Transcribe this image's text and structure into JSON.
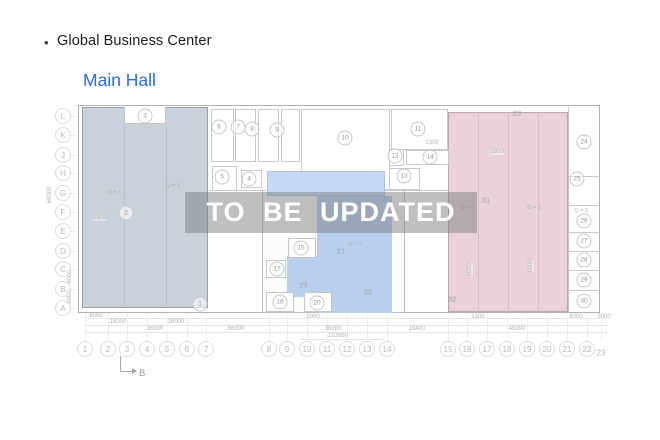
{
  "header": {
    "bullet": "•",
    "title": "Global Business Center",
    "link": "Main Hall"
  },
  "watermark": {
    "text": "TO BE UPDATED"
  },
  "section_marker": {
    "label": "B"
  },
  "colors": {
    "link_blue": "#2a6bdb",
    "zone_left": "#c9d2db",
    "zone_middle": "#b9cfee",
    "zone_middle_light": "#c6d7f3",
    "zone_right_pink": "#ead2da",
    "watermark_band": "rgba(124,127,130,0.5)",
    "watermark_text": "#ffffff",
    "drawing_line": "#c9c9c9"
  },
  "plan": {
    "row_labels": [
      {
        "t": "L",
        "x": 63,
        "y": 116
      },
      {
        "t": "K",
        "x": 63,
        "y": 135
      },
      {
        "t": "J",
        "x": 63,
        "y": 155
      },
      {
        "t": "H",
        "x": 63,
        "y": 173
      },
      {
        "t": "G",
        "x": 63,
        "y": 193
      },
      {
        "t": "F",
        "x": 63,
        "y": 212
      },
      {
        "t": "E",
        "x": 63,
        "y": 231
      },
      {
        "t": "D",
        "x": 63,
        "y": 251
      },
      {
        "t": "C",
        "x": 63,
        "y": 269
      },
      {
        "t": "B",
        "x": 63,
        "y": 289
      },
      {
        "t": "A",
        "x": 63,
        "y": 308
      }
    ],
    "col_labels": [
      {
        "t": "1",
        "x": 85,
        "y": 349
      },
      {
        "t": "2",
        "x": 108,
        "y": 349
      },
      {
        "t": "3",
        "x": 127,
        "y": 349
      },
      {
        "t": "4",
        "x": 147,
        "y": 349
      },
      {
        "t": "5",
        "x": 167,
        "y": 349
      },
      {
        "t": "6",
        "x": 187,
        "y": 349
      },
      {
        "t": "7",
        "x": 206,
        "y": 349
      },
      {
        "t": "8",
        "x": 269,
        "y": 349
      },
      {
        "t": "9",
        "x": 287,
        "y": 349
      },
      {
        "t": "10",
        "x": 307,
        "y": 349
      },
      {
        "t": "11",
        "x": 327,
        "y": 349
      },
      {
        "t": "12",
        "x": 347,
        "y": 349
      },
      {
        "t": "13",
        "x": 367,
        "y": 349
      },
      {
        "t": "14",
        "x": 387,
        "y": 349
      },
      {
        "t": "15",
        "x": 448,
        "y": 349
      },
      {
        "t": "16",
        "x": 467,
        "y": 349
      },
      {
        "t": "17",
        "x": 487,
        "y": 349
      },
      {
        "t": "18",
        "x": 507,
        "y": 349
      },
      {
        "t": "19",
        "x": 527,
        "y": 349
      },
      {
        "t": "20",
        "x": 547,
        "y": 349
      },
      {
        "t": "21",
        "x": 567,
        "y": 349
      },
      {
        "t": "22",
        "x": 587,
        "y": 349
      },
      {
        "t": "23",
        "x": 601,
        "y": 353,
        "circle": false
      }
    ],
    "room_labels": [
      {
        "t": "3",
        "x": 145,
        "y": 116
      },
      {
        "t": "2",
        "x": 126,
        "y": 213
      },
      {
        "t": "1",
        "x": 200,
        "y": 304
      },
      {
        "t": "6",
        "x": 219,
        "y": 127
      },
      {
        "t": "7",
        "x": 238,
        "y": 127
      },
      {
        "t": "8",
        "x": 252,
        "y": 129
      },
      {
        "t": "9",
        "x": 277,
        "y": 130
      },
      {
        "t": "5",
        "x": 222,
        "y": 177
      },
      {
        "t": "4",
        "x": 249,
        "y": 179
      },
      {
        "t": "10",
        "x": 345,
        "y": 138
      },
      {
        "t": "11",
        "x": 418,
        "y": 129
      },
      {
        "t": "12",
        "x": 395,
        "y": 156
      },
      {
        "t": "13",
        "x": 404,
        "y": 176
      },
      {
        "t": "14",
        "x": 430,
        "y": 157
      },
      {
        "t": "15",
        "x": 301,
        "y": 248
      },
      {
        "t": "17",
        "x": 277,
        "y": 269
      },
      {
        "t": "18",
        "x": 280,
        "y": 302
      },
      {
        "t": "20",
        "x": 317,
        "y": 303
      },
      {
        "t": "19",
        "x": 303,
        "y": 285,
        "circle": false
      },
      {
        "t": "21",
        "x": 341,
        "y": 251,
        "circle": false
      },
      {
        "t": "22",
        "x": 368,
        "y": 292,
        "circle": false
      },
      {
        "t": "23",
        "x": 517,
        "y": 113,
        "circle": false
      },
      {
        "t": "24",
        "x": 584,
        "y": 142
      },
      {
        "t": "25",
        "x": 577,
        "y": 179
      },
      {
        "t": "26",
        "x": 584,
        "y": 221
      },
      {
        "t": "27",
        "x": 584,
        "y": 241
      },
      {
        "t": "28",
        "x": 584,
        "y": 260
      },
      {
        "t": "29",
        "x": 584,
        "y": 280
      },
      {
        "t": "30",
        "x": 584,
        "y": 301
      },
      {
        "t": "31",
        "x": 486,
        "y": 200,
        "circle": false
      },
      {
        "t": "32",
        "x": 452,
        "y": 299,
        "circle": false
      }
    ],
    "dim_labels": [
      {
        "t": "6000",
        "x": 96,
        "y": 316
      },
      {
        "t": "18000",
        "x": 118,
        "y": 322
      },
      {
        "t": "18000",
        "x": 176,
        "y": 322
      },
      {
        "t": "36000",
        "x": 155,
        "y": 329
      },
      {
        "t": "56000",
        "x": 236,
        "y": 329
      },
      {
        "t": "2000",
        "x": 313,
        "y": 317
      },
      {
        "t": "36000",
        "x": 333,
        "y": 329
      },
      {
        "t": "153860",
        "x": 338,
        "y": 336
      },
      {
        "t": "18400",
        "x": 417,
        "y": 329
      },
      {
        "t": "1300",
        "x": 478,
        "y": 317
      },
      {
        "t": "45000",
        "x": 517,
        "y": 329
      },
      {
        "t": "6000",
        "x": 576,
        "y": 317
      },
      {
        "t": "3000",
        "x": 604,
        "y": 317
      },
      {
        "t": "1300",
        "x": 432,
        "y": 143
      },
      {
        "t": "1800",
        "x": 497,
        "y": 152
      },
      {
        "t": "2600",
        "x": 100,
        "y": 218
      },
      {
        "t": "60000",
        "x": 50,
        "y": 195,
        "rot": true
      },
      {
        "t": "6000",
        "x": 70,
        "y": 277,
        "rot": true
      },
      {
        "t": "6000",
        "x": 70,
        "y": 297,
        "rot": true
      },
      {
        "t": "6000",
        "x": 470,
        "y": 270,
        "rot": true
      },
      {
        "t": "6000",
        "x": 531,
        "y": 266,
        "rot": true
      }
    ],
    "area_labels": [
      {
        "t": "Q = 3",
        "x": 114,
        "y": 193
      },
      {
        "t": "Q = 3",
        "x": 173,
        "y": 186
      },
      {
        "t": "Q = 3",
        "x": 355,
        "y": 244
      },
      {
        "t": "Q = 3",
        "x": 467,
        "y": 208
      },
      {
        "t": "Q = 3",
        "x": 534,
        "y": 208
      },
      {
        "t": "Q = 3",
        "x": 581,
        "y": 211
      }
    ]
  }
}
